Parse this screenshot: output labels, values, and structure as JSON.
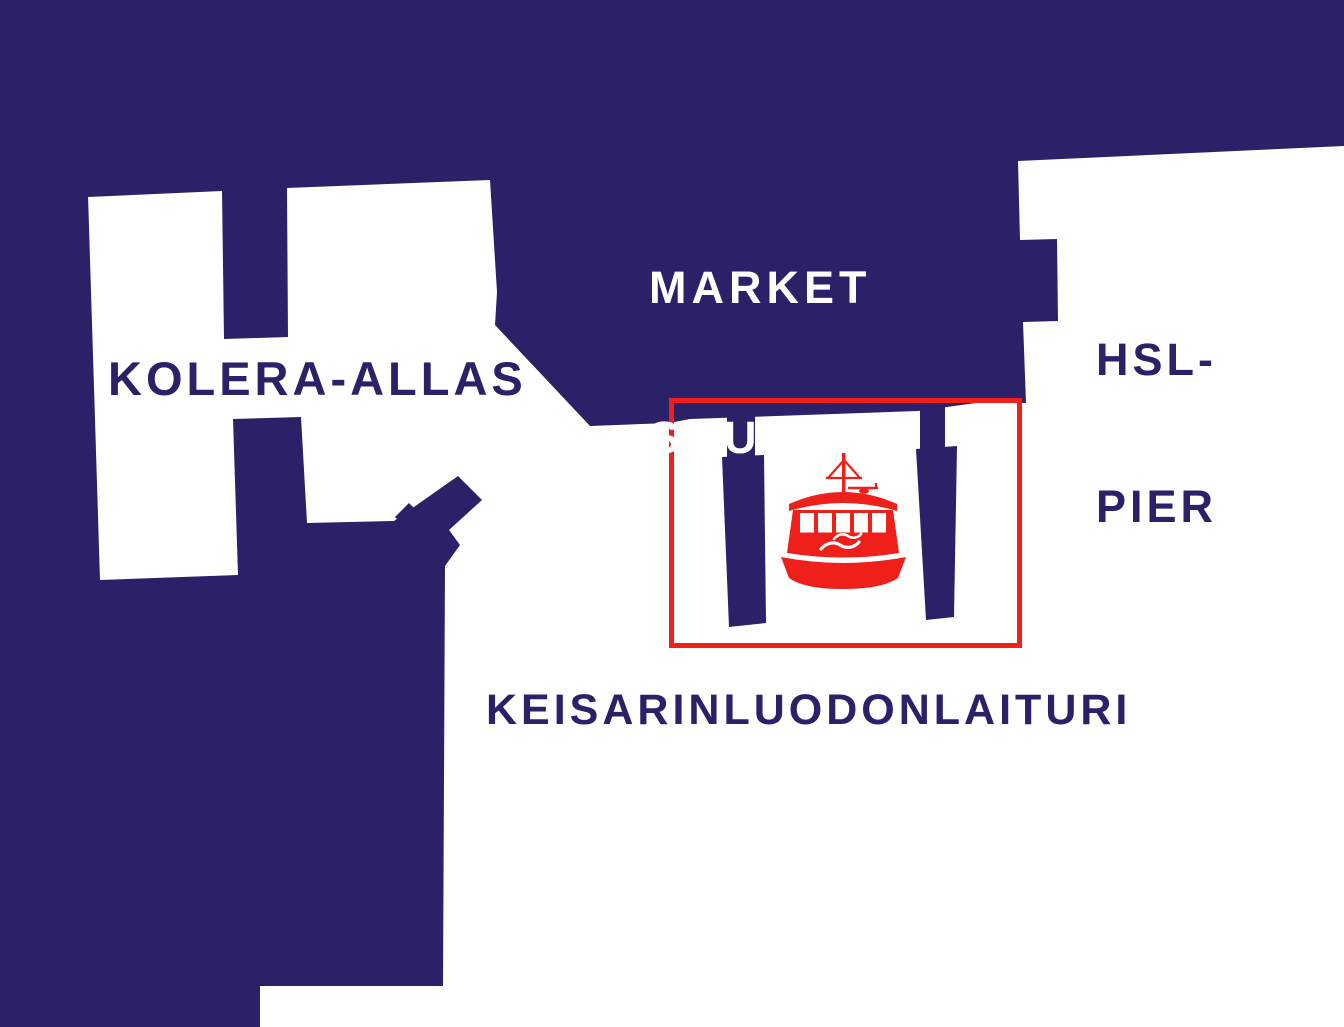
{
  "colors": {
    "navy": "#2a2169",
    "red": "#ee2019",
    "background": "#ffffff"
  },
  "labels": {
    "market_square": {
      "line1": "MARKET",
      "line2": "SQUARE"
    },
    "hsl_pier": {
      "line1": "HSL-",
      "line2": "PIER"
    },
    "kolera_allas": "KOLERA-ALLAS",
    "keisarinluodonlaituri": "KEISARINLUODONLAITURI"
  },
  "icons": {
    "ferry": "ferry-icon"
  }
}
